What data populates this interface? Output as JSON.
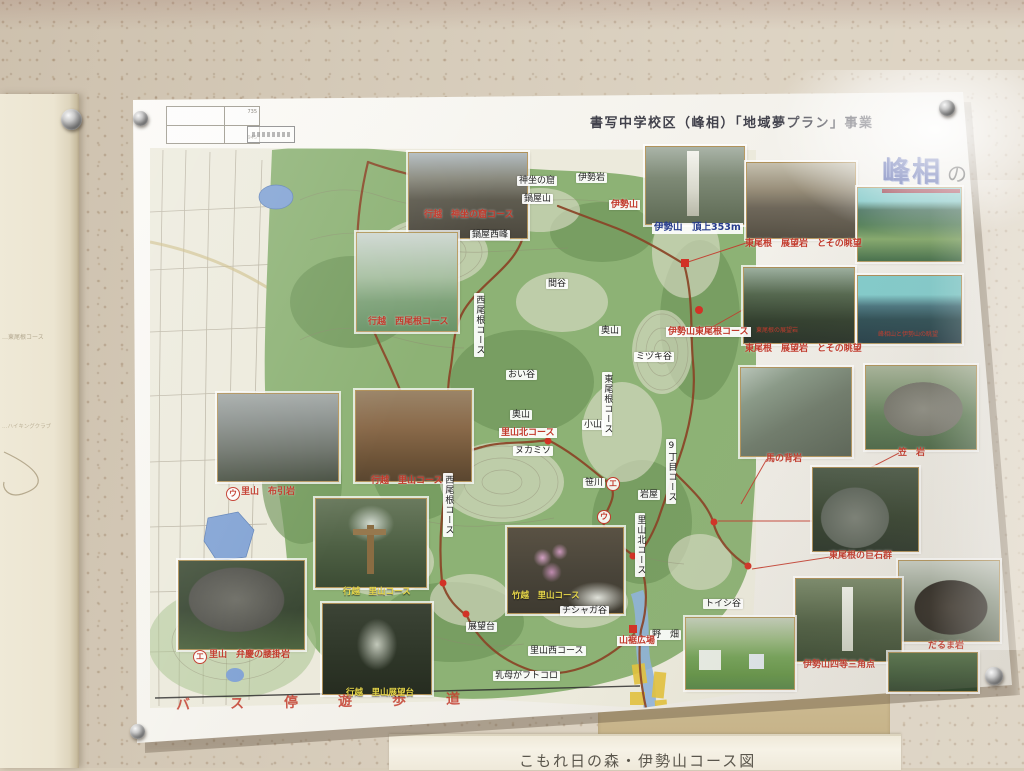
{
  "poster": {
    "program_title": "書写中学校区（峰相）「地域夢プラン」事業",
    "corner_title_main": "峰相",
    "corner_title_particle": "の",
    "scale_numbers": [
      "735",
      "945"
    ]
  },
  "bottom_sheet": {
    "title": "こもれ日の森・伊勢山コース図"
  },
  "left_sheet": {
    "faint_lines": [
      "…東尾根コース",
      "…ハイキングクラブ"
    ]
  },
  "map": {
    "bus_route_text": "バス停遊歩道",
    "boxed_labels": [
      {
        "text": "神坐の窟",
        "x": 517,
        "y": 176
      },
      {
        "text": "鍋屋山",
        "x": 522,
        "y": 194
      },
      {
        "text": "伊勢岩",
        "x": 576,
        "y": 173
      },
      {
        "text": "鍋屋西峰",
        "x": 470,
        "y": 230
      },
      {
        "text": "間谷",
        "x": 546,
        "y": 279
      },
      {
        "text": "奥山",
        "x": 599,
        "y": 326
      },
      {
        "text": "ミヅキ谷",
        "x": 634,
        "y": 352
      },
      {
        "text": "おい谷",
        "x": 506,
        "y": 370
      },
      {
        "text": "奥山",
        "x": 510,
        "y": 410
      },
      {
        "text": "小山",
        "x": 582,
        "y": 420
      },
      {
        "text": "ヌカミソ",
        "x": 513,
        "y": 446
      },
      {
        "text": "笹川",
        "x": 583,
        "y": 478
      },
      {
        "text": "岩屋",
        "x": 638,
        "y": 490
      },
      {
        "text": "展望台",
        "x": 466,
        "y": 622
      },
      {
        "text": "里山西コース",
        "x": 528,
        "y": 646
      },
      {
        "text": "乳母がフトコロ",
        "x": 493,
        "y": 671
      },
      {
        "text": "チシャガ谷",
        "x": 560,
        "y": 606
      },
      {
        "text": "トイシ谷",
        "x": 703,
        "y": 599
      },
      {
        "text": "野　畑",
        "x": 650,
        "y": 630
      }
    ],
    "vertical_labels": [
      {
        "text": "西尾根コース",
        "x": 474,
        "y": 293
      },
      {
        "text": "東尾根コース",
        "x": 602,
        "y": 372
      },
      {
        "text": "9丁目コース",
        "x": 666,
        "y": 439
      },
      {
        "text": "里山北コース",
        "x": 635,
        "y": 513
      },
      {
        "text": "西尾根コース",
        "x": 443,
        "y": 473
      }
    ],
    "red_labels": [
      {
        "text": "行越　神坐の窟コース",
        "x": 424,
        "y": 210
      },
      {
        "text": "行越　西尾根コース",
        "x": 368,
        "y": 317
      },
      {
        "text": "伊勢山",
        "x": 609,
        "y": 200,
        "boxed": true
      },
      {
        "text": "東尾根　展望岩　とその眺望",
        "x": 745,
        "y": 239
      },
      {
        "text": "伊勢山東尾根コース",
        "x": 666,
        "y": 327,
        "boxed": true
      },
      {
        "text": "東尾根　展望岩　とその眺望",
        "x": 745,
        "y": 344
      },
      {
        "text": "里山北コース",
        "x": 499,
        "y": 428,
        "boxed": true
      },
      {
        "text": "馬の背岩",
        "x": 766,
        "y": 454
      },
      {
        "text": "笠　岩",
        "x": 898,
        "y": 448
      },
      {
        "text": "東尾根の巨石群",
        "x": 829,
        "y": 551
      },
      {
        "text": "だるま岩",
        "x": 928,
        "y": 641
      },
      {
        "text": "伊勢山四等三角点",
        "x": 803,
        "y": 660
      },
      {
        "text": "里山　布引岩",
        "x": 241,
        "y": 487
      },
      {
        "text": "行越　里山コース",
        "x": 371,
        "y": 476
      },
      {
        "text": "里山　弁慶の腰掛岩",
        "x": 209,
        "y": 650
      },
      {
        "text": "山裾広場",
        "x": 617,
        "y": 636,
        "boxed": true
      }
    ],
    "tiny_red_labels": [
      {
        "text": "東尾根の展望岩",
        "x": 756,
        "y": 328
      },
      {
        "text": "峰相山と伊勢山の眺望",
        "x": 878,
        "y": 332
      }
    ],
    "yellow_labels": [
      {
        "text": "行越　里山コース",
        "x": 343,
        "y": 588
      },
      {
        "text": "竹越　里山コース",
        "x": 512,
        "y": 592
      },
      {
        "text": "行越　里山展望台",
        "x": 346,
        "y": 689
      }
    ],
    "blue_labels": [
      {
        "text": "伊勢山　頂上353m",
        "x": 652,
        "y": 223
      }
    ],
    "circled_markers": [
      {
        "text": "ウ",
        "x": 226,
        "y": 487
      },
      {
        "text": "エ",
        "x": 193,
        "y": 650
      },
      {
        "text": "エ",
        "x": 606,
        "y": 477
      },
      {
        "text": "ウ",
        "x": 597,
        "y": 510
      }
    ]
  },
  "photos": [
    {
      "name": "shinza-no-iwaya",
      "x": 408,
      "y": 152,
      "w": 118,
      "h": 85,
      "bg": "linear-gradient(180deg,#b3bcc0,#8a8a7e 30%,#5f5c50 55%,#4c483e)"
    },
    {
      "name": "west-ridge-view",
      "x": 356,
      "y": 232,
      "w": 100,
      "h": 98,
      "bg": "linear-gradient(180deg,#cfd8d2,#a8c0a2 45%,#7fa37a 70%,#6b9468)"
    },
    {
      "name": "iseyama-summit",
      "x": 645,
      "y": 146,
      "w": 98,
      "h": 77,
      "bg": "linear-gradient(180deg,#aab4a8,#7e8a76 40%,#5e6a54)",
      "overlays": [
        {
          "l": "42%",
          "t": "5%",
          "w": "12%",
          "h": "85%",
          "bg": "linear-gradient(180deg,#f4f4ee,#d8d8cc 60%,#b8b8a8)"
        }
      ]
    },
    {
      "name": "east-ridge-rock-1",
      "x": 746,
      "y": 162,
      "w": 108,
      "h": 75,
      "bg": "linear-gradient(180deg,#c4bfae,#998f7a 35%,#6e675a 60%,#565044)"
    },
    {
      "name": "teal-valley",
      "x": 857,
      "y": 187,
      "w": 103,
      "h": 73,
      "bg": "linear-gradient(180deg,#79c6c6 0%,#79c6c6 18%,#3c6a55 30%,#54805a 50%,#87aa6e 70%,#46704c)"
    },
    {
      "name": "east-ridge-rock-2",
      "x": 743,
      "y": 267,
      "w": 110,
      "h": 75,
      "bg": "linear-gradient(180deg,#9caf9e,#55684f 35%,#33402f 70%,#2a342a)"
    },
    {
      "name": "teal-mountains",
      "x": 857,
      "y": 275,
      "w": 103,
      "h": 67,
      "bg": "linear-gradient(180deg,#83cccc 0%,#83cccc 28%,#4b7680 45%,#2f4f55 65%,#27404a)"
    },
    {
      "name": "uma-no-se-iwa",
      "x": 740,
      "y": 367,
      "w": 110,
      "h": 88,
      "bg": "linear-gradient(150deg,#b8c4b8 0%,#8a9a88 25%,#707c6c 55%,#5a6456)"
    },
    {
      "name": "kasa-iwa",
      "x": 865,
      "y": 365,
      "w": 110,
      "h": 83,
      "bg": "radial-gradient(ellipse 42% 38% at 52% 52%,#8e8e84 0%,#77776d 85%,rgba(0,0,0,0) 86%),linear-gradient(180deg,#a8b49a,#62805a 60%,#4c6848)"
    },
    {
      "name": "kyosekigun",
      "x": 812,
      "y": 467,
      "w": 105,
      "h": 83,
      "bg": "radial-gradient(ellipse 40% 45% at 40% 60%,#7a8076 0%,#5e665c 80%,rgba(0,0,0,0) 82%),linear-gradient(180deg,#4e5c4a,#35422f 60%,#2b362a)"
    },
    {
      "name": "daruma-iwa",
      "x": 898,
      "y": 560,
      "w": 100,
      "h": 80,
      "bg": "radial-gradient(ellipse 45% 42% at 52% 58%,#38322a 0%,#2c2822 80%,rgba(0,0,0,0) 82%),linear-gradient(180deg,#c6ccc2,#8a9684 50%,#5c6854)"
    },
    {
      "name": "sankakuten",
      "x": 795,
      "y": 578,
      "w": 105,
      "h": 82,
      "bg": "linear-gradient(180deg,#7a8a6a,#4e5e42 55%,#3a4a32)",
      "overlays": [
        {
          "l": "44%",
          "t": "10%",
          "w": "10%",
          "h": "78%",
          "bg": "linear-gradient(180deg,#eef0e8,#ccd0c2)"
        }
      ]
    },
    {
      "name": "yamasuso-park",
      "x": 685,
      "y": 617,
      "w": 108,
      "h": 71,
      "bg": "linear-gradient(180deg,#c2ccb8 0%,#9ab882 30%,#74a258 55%,#659448 80%,#58864a)",
      "overlays": [
        {
          "l": "12%",
          "t": "45%",
          "w": "20%",
          "h": "28%",
          "bg": "#e8ece4"
        },
        {
          "l": "58%",
          "t": "50%",
          "w": "14%",
          "h": "22%",
          "bg": "#dfe6ea"
        }
      ]
    },
    {
      "name": "bottom-right-partial",
      "x": 888,
      "y": 652,
      "w": 88,
      "h": 38,
      "bg": "linear-gradient(180deg,#55724a,#3e5838 60%,#31452e)"
    },
    {
      "name": "nunobiki-iwa",
      "x": 217,
      "y": 393,
      "w": 120,
      "h": 87,
      "bg": "linear-gradient(180deg,#a4aaa8 0%,#888e8a 35%,#6e746c 65%,#4a5244)"
    },
    {
      "name": "yukikoshi-autumn",
      "x": 355,
      "y": 390,
      "w": 115,
      "h": 90,
      "bg": "linear-gradient(180deg,#9a8468,#8a6a4a 40%,#6e5438 75%,#5a4630)"
    },
    {
      "name": "signpost-crossing",
      "x": 315,
      "y": 498,
      "w": 110,
      "h": 88,
      "bg": "radial-gradient(ellipse 30% 30% at 50% 28%,#d4dcd2 0%,rgba(0,0,0,0) 70%),linear-gradient(180deg,#6a7a5e,#4e6044 55%,#3c4c34)",
      "overlays": [
        {
          "l": "46%",
          "t": "30%",
          "w": "7%",
          "h": "55%",
          "bg": "#8a6c42"
        },
        {
          "l": "34%",
          "t": "34%",
          "w": "30%",
          "h": "7%",
          "bg": "#96784e"
        }
      ]
    },
    {
      "name": "benkei-iwa",
      "x": 178,
      "y": 560,
      "w": 125,
      "h": 88,
      "bg": "radial-gradient(ellipse 46% 44% at 46% 44%,#6e6e66 0%,#565650 82%,rgba(0,0,0,0) 84%),linear-gradient(180deg,#44523c,#3a4834 55%,#4e6440)"
    },
    {
      "name": "dark-trail",
      "x": 322,
      "y": 603,
      "w": 108,
      "h": 90,
      "bg": "radial-gradient(ellipse 26% 40% at 50% 45%,#c2c8ba 0%,rgba(0,0,0,0) 72%),linear-gradient(180deg,#3c4436,#2e3628 60%,#262c20)"
    },
    {
      "name": "flower-stream",
      "x": 507,
      "y": 527,
      "w": 115,
      "h": 85,
      "bg": "radial-gradient(circle 9px at 30% 35%,#d4a2c4 0%,rgba(0,0,0,0) 100%),radial-gradient(circle 8px at 45% 28%,#cc98bc 0%,rgba(0,0,0,0) 100%),radial-gradient(circle 10px at 38% 52%,#c08cb0 0%,rgba(0,0,0,0) 100%),radial-gradient(ellipse 35% 25% at 78% 82%,#e0e2da 0%,rgba(0,0,0,0) 75%),linear-gradient(180deg,#5a5244,#4a453a 50%,#3e3a30)"
    }
  ],
  "colors": {
    "label_red": "#c2392b",
    "caption_yellow": "#e8d84a",
    "title_blue": "#33459c",
    "underline_dark_red": "#8c2433",
    "trail_brown": "#8a4426",
    "water_blue": "#82a3d4",
    "field_yellow": "#e4c33c"
  }
}
